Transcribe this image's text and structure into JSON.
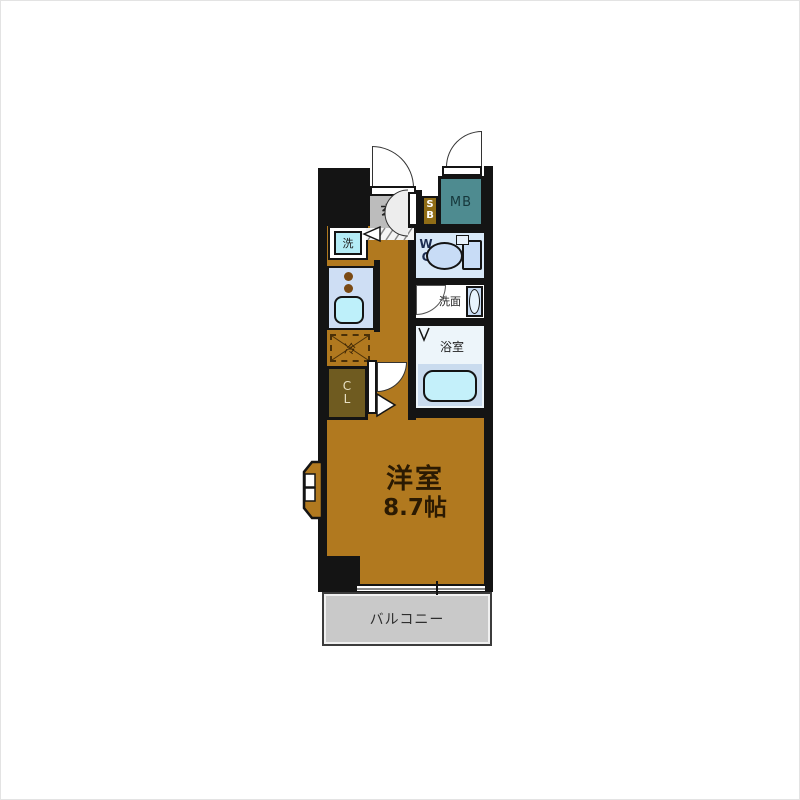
{
  "title": "apartment-floor-plan",
  "labels": {
    "entrance": "玄",
    "shoe_box": "SB",
    "meter_box": "MB",
    "washer": "洗",
    "refrigerator": "冷",
    "closet": "CL",
    "toilet": "WC",
    "washroom": "洗面",
    "bathroom": "浴室",
    "main_room_name": "洋室",
    "main_room_size": "8.7帖",
    "balcony": "バルコニー"
  },
  "colors": {
    "wall": "#141414",
    "floor": "#b1791f",
    "entrance_floor": "#bcbcbc",
    "shoe_box": "#8f6c16",
    "meter_box": "#4e8b90",
    "washer": "#b4ecf6",
    "kitchen_counter": "#cedef4",
    "sink": "#bef0fa",
    "burner": "#7a4a14",
    "wc_floor": "#d8e8f8",
    "toilet": "#c8dcf6",
    "washroom_floor": "#ffffff",
    "vanity": "#c8dcf4",
    "bathroom_floor": "#edf5fa",
    "tub_area": "#c9dbee",
    "bathtub": "#c4f0fa",
    "closet": "#6f5b20",
    "closet_text": "#e8e0c4",
    "balcony_floor": "#c9c9c9",
    "room_text": "#2b1a02"
  }
}
